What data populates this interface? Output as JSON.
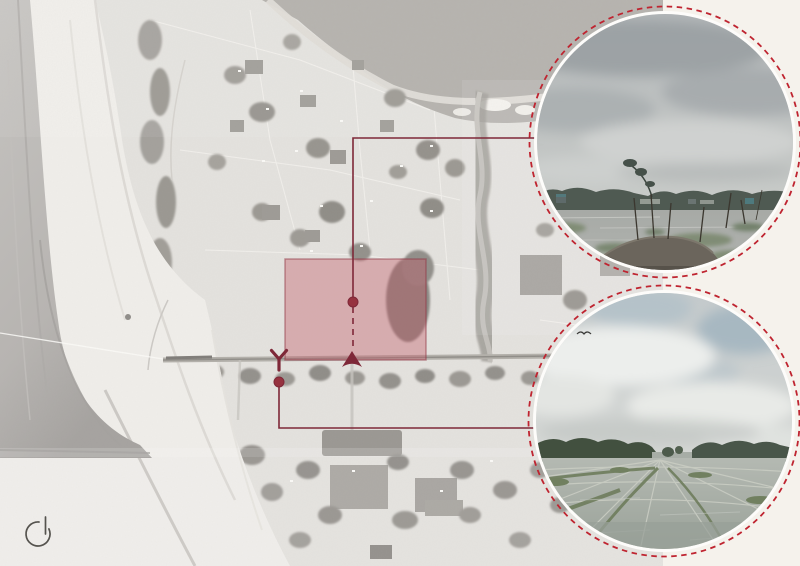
{
  "canvas": {
    "width": 800,
    "height": 566,
    "background_color": "#f5f2ec"
  },
  "map": {
    "kind": "grayscale-aerial-basemap",
    "base_color": "#e4e2de",
    "water_color": "#bdbab6",
    "sand_color": "#f0eeea",
    "vegetation_color": "#9b9893",
    "right_edge_x": 663
  },
  "site_overlay": {
    "fill": "#c25864",
    "fill_opacity": "0.38",
    "outline": "#8f3543"
  },
  "connector": {
    "color": "#7e2838",
    "dot_color": "#96323f",
    "marker_color": "#7e2838",
    "dash_pattern": "6 5"
  },
  "insets": {
    "border_color": "#bf2430",
    "border_style": "dashed",
    "shape": "circle",
    "items": [
      {
        "name": "site-photo-north",
        "subject": "flooded field with mud mound and bare sticks, tree line under heavy overcast sky"
      },
      {
        "name": "site-photo-south",
        "subject": "flooded rice paddies with grassy dikes, trees at horizon, cloudy sky with a bird"
      }
    ]
  },
  "north_icon": {
    "color": "#55534e"
  }
}
